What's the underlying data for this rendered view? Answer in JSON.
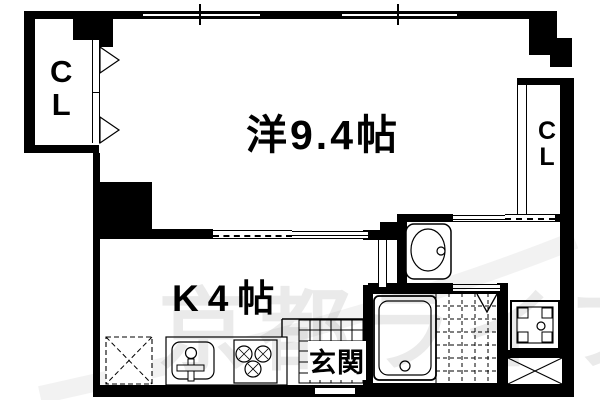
{
  "plan": {
    "type": "apartment-floorplan",
    "labels": {
      "main_room": "洋9.4帖",
      "kitchen": "K4帖",
      "entrance": "玄関",
      "closet_left": {
        "line1": "C",
        "line2": "L"
      },
      "closet_right": {
        "line1": "C",
        "line2": "L"
      }
    },
    "watermark_text": "京都ライフ",
    "colors": {
      "wall": "#000000",
      "background": "#ffffff",
      "watermark": "#000000"
    },
    "fixtures": [
      "bathtub",
      "toilet",
      "washbasin",
      "washing-machine-space",
      "refrigerator-space",
      "kitchen-sink",
      "gas-stove",
      "entrance-tile-floor",
      "bathroom-tile-floor",
      "closet-folding-door",
      "sliding-window",
      "sliding-door"
    ]
  }
}
